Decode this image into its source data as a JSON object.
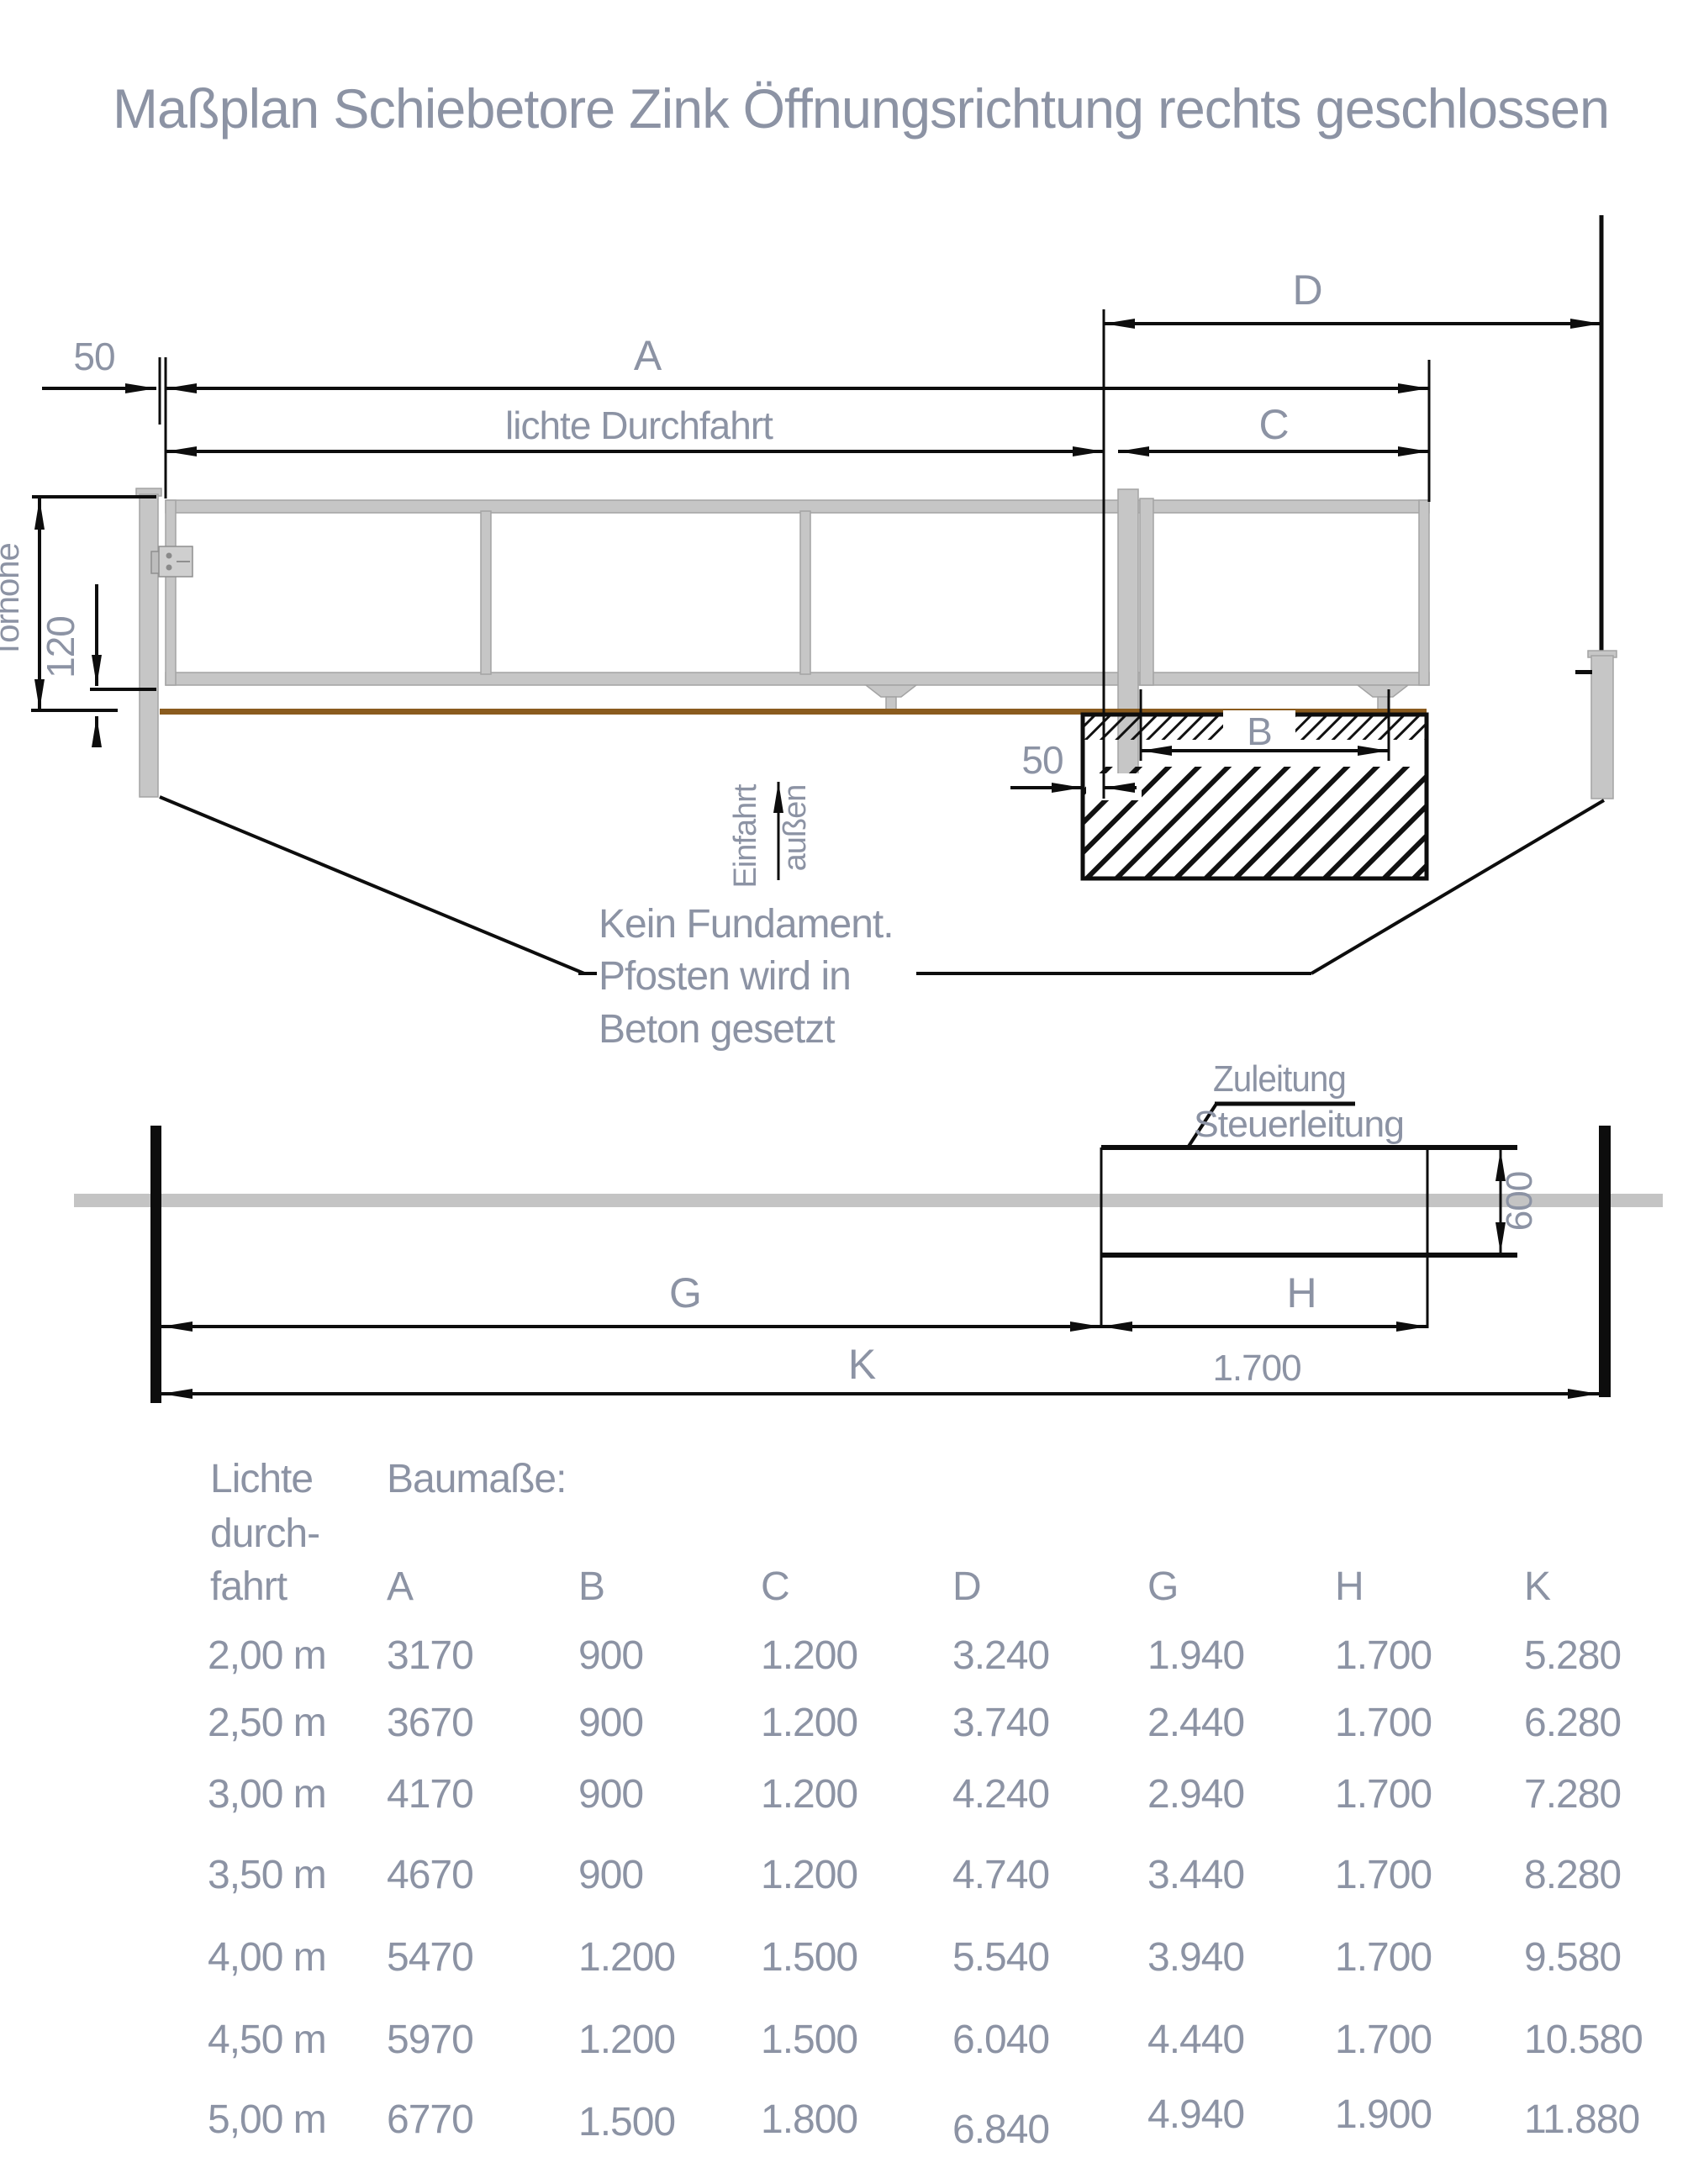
{
  "title": "Maßplan Schiebetore Zink Öffnungsrichtung rechts geschlossen",
  "colors": {
    "label_text": "#8C93A4",
    "drawing_line": "#0D0D0D",
    "gate_steel": "#C6C6C6",
    "ground_brown": "#8A5B1E",
    "fence_band_gray": "#C4C4C4"
  },
  "upper": {
    "dim_50_left": "50",
    "dim_a": "A",
    "lichte_durchfahrt": "lichte Durchfahrt",
    "dim_d": "D",
    "dim_c": "C",
    "dim_b": "B",
    "dim_50_bottom": "50",
    "torhoehe": "Torhöhe",
    "dim_120": "120",
    "einfahrt": "Einfahrt",
    "aussen": "außen",
    "note_line1": "Kein Fundament.",
    "note_line2": "Pfosten wird in",
    "note_line3": "Beton gesetzt"
  },
  "lower": {
    "zuleitung": "Zuleitung",
    "steuerleitung": "Steuerleitung",
    "dim_600": "600",
    "dim_g": "G",
    "dim_h": "H",
    "dim_k": "K",
    "dim_1700": "1.700"
  },
  "table": {
    "col1_header": [
      "Lichte",
      "durch-",
      "fahrt"
    ],
    "group_header": "Baumaße:",
    "columns": [
      "A",
      "B",
      "C",
      "D",
      "G",
      "H",
      "K"
    ],
    "rows": [
      {
        "label": "2,00 m",
        "values": [
          "3170",
          "900",
          "1.200",
          "3.240",
          "1.940",
          "1.700",
          "5.280"
        ]
      },
      {
        "label": "2,50 m",
        "values": [
          "3670",
          "900",
          "1.200",
          "3.740",
          "2.440",
          "1.700",
          "6.280"
        ]
      },
      {
        "label": "3,00 m",
        "values": [
          "4170",
          "900",
          "1.200",
          "4.240",
          "2.940",
          "1.700",
          "7.280"
        ]
      },
      {
        "label": "3,50 m",
        "values": [
          "4670",
          "900",
          "1.200",
          "4.740",
          "3.440",
          "1.700",
          "8.280"
        ]
      },
      {
        "label": "4,00 m",
        "values": [
          "5470",
          "1.200",
          "1.500",
          "5.540",
          "3.940",
          "1.700",
          "9.580"
        ]
      },
      {
        "label": "4,50 m",
        "values": [
          "5970",
          "1.200",
          "1.500",
          "6.040",
          "4.440",
          "1.700",
          "10.580"
        ]
      },
      {
        "label": "5,00 m",
        "values": [
          "6770",
          "1.500",
          "1.800",
          "6.840",
          "4.940",
          "1.900",
          "11.880"
        ]
      }
    ]
  }
}
